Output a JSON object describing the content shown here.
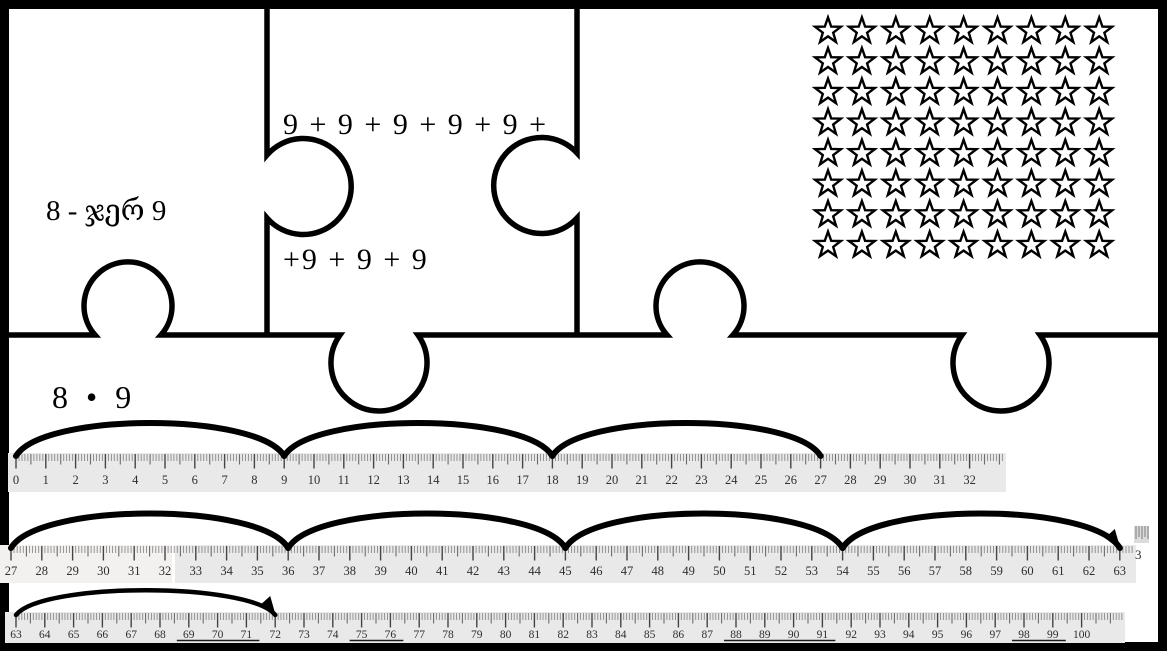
{
  "pieces": {
    "multiplication": {
      "line1": "8 - ჯერ 9",
      "line2": "8 • 9"
    },
    "addition": {
      "line1": "9 + 9 + 9 + 9 + 9 +",
      "line2": "+9 + 9 + 9"
    },
    "star_array": {
      "rows": 8,
      "cols": 9,
      "total_stars": 72,
      "icon": "star-outline"
    }
  },
  "number_lines": [
    {
      "start": 0,
      "end": 32,
      "jumps": [
        {
          "from": 0,
          "to": 9
        },
        {
          "from": 9,
          "to": 18
        },
        {
          "from": 18,
          "to": 27
        }
      ],
      "arrow_on_last_jump": false,
      "underlined_labels": []
    },
    {
      "start": 27,
      "end": 63,
      "jumps": [
        {
          "from": 27,
          "to": 36
        },
        {
          "from": 36,
          "to": 45
        },
        {
          "from": 45,
          "to": 54
        },
        {
          "from": 54,
          "to": 63
        }
      ],
      "arrow_on_last_jump": true,
      "underlined_labels": []
    },
    {
      "start": 63,
      "end": 100,
      "jumps": [
        {
          "from": 63,
          "to": 72
        }
      ],
      "arrow_on_last_jump": true,
      "underlined_labels": [
        [
          69,
          71
        ],
        [
          75,
          76
        ],
        [
          88,
          91
        ],
        [
          98,
          99
        ]
      ]
    }
  ],
  "fragment": {
    "label": "3"
  },
  "colors": {
    "ink": "#000000",
    "ruler_bg": "#e9e9e9",
    "ruler_bg_light": "#f3f1ef",
    "tick_minor": "#8a8a8a",
    "tick_half": "#6d6d6d",
    "tick_major": "#454545",
    "label": "#2e2e2e"
  }
}
